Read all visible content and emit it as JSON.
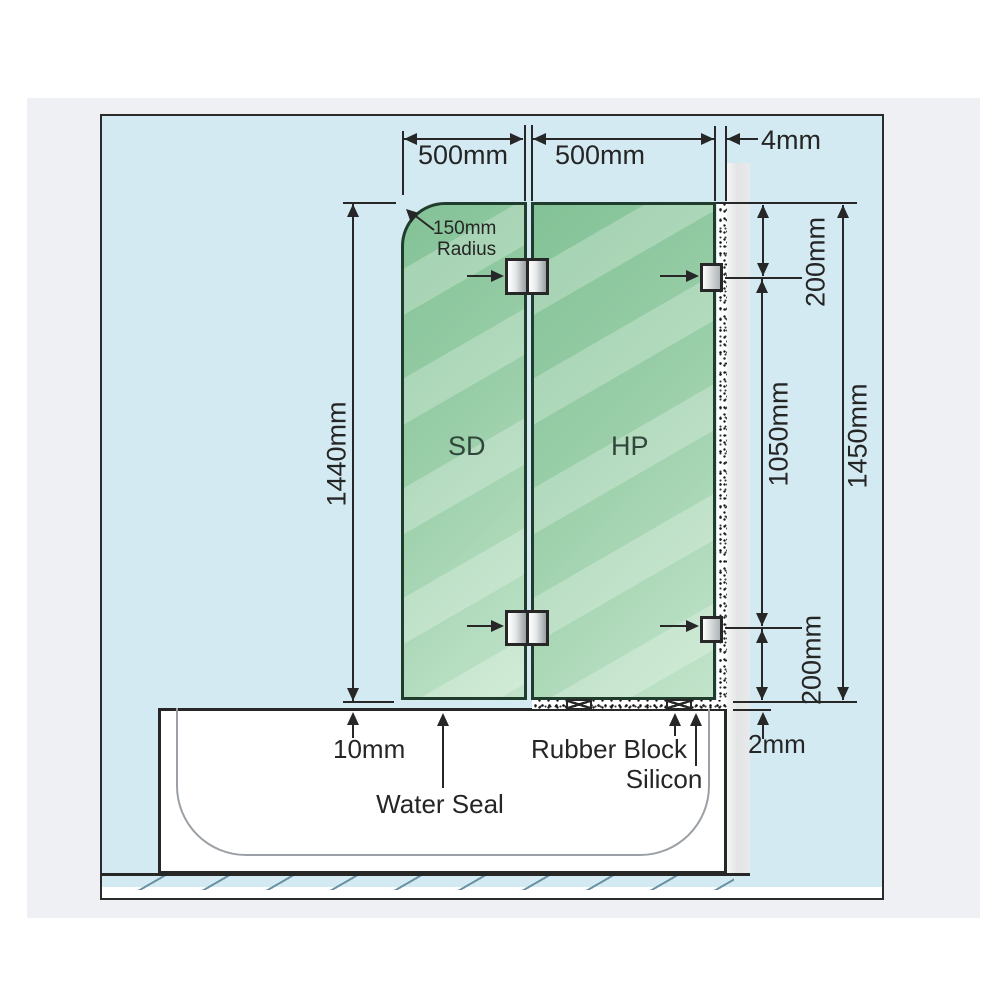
{
  "colors": {
    "background_blue": "#d3eaf2",
    "card_gray": "#eef0f3",
    "glass_green_dark": "#83c296",
    "glass_green_light": "#c2e4ca",
    "line_dark": "#272727",
    "wall_gray": "#e4e6e8"
  },
  "diagram": {
    "top_dimensions": {
      "panel1_width": "500mm",
      "panel2_width": "500mm",
      "wall_gap": "4mm"
    },
    "corner_note": {
      "line1": "150mm",
      "line2": "Radius"
    },
    "panels": {
      "left_label": "SD",
      "right_label": "HP"
    },
    "left_dimension": {
      "panel1_height": "1440mm"
    },
    "right_dimensions": {
      "top_bracket_offset": "200mm",
      "bracket_spacing": "1050mm",
      "panel2_height": "1450mm",
      "bottom_bracket_offset": "200mm",
      "silicon_bed": "2mm"
    },
    "bottom_annotations": {
      "panel_tub_gap": "10mm",
      "water_seal": "Water Seal",
      "rubber_block": "Rubber Block",
      "silicon": "Silicon"
    }
  }
}
